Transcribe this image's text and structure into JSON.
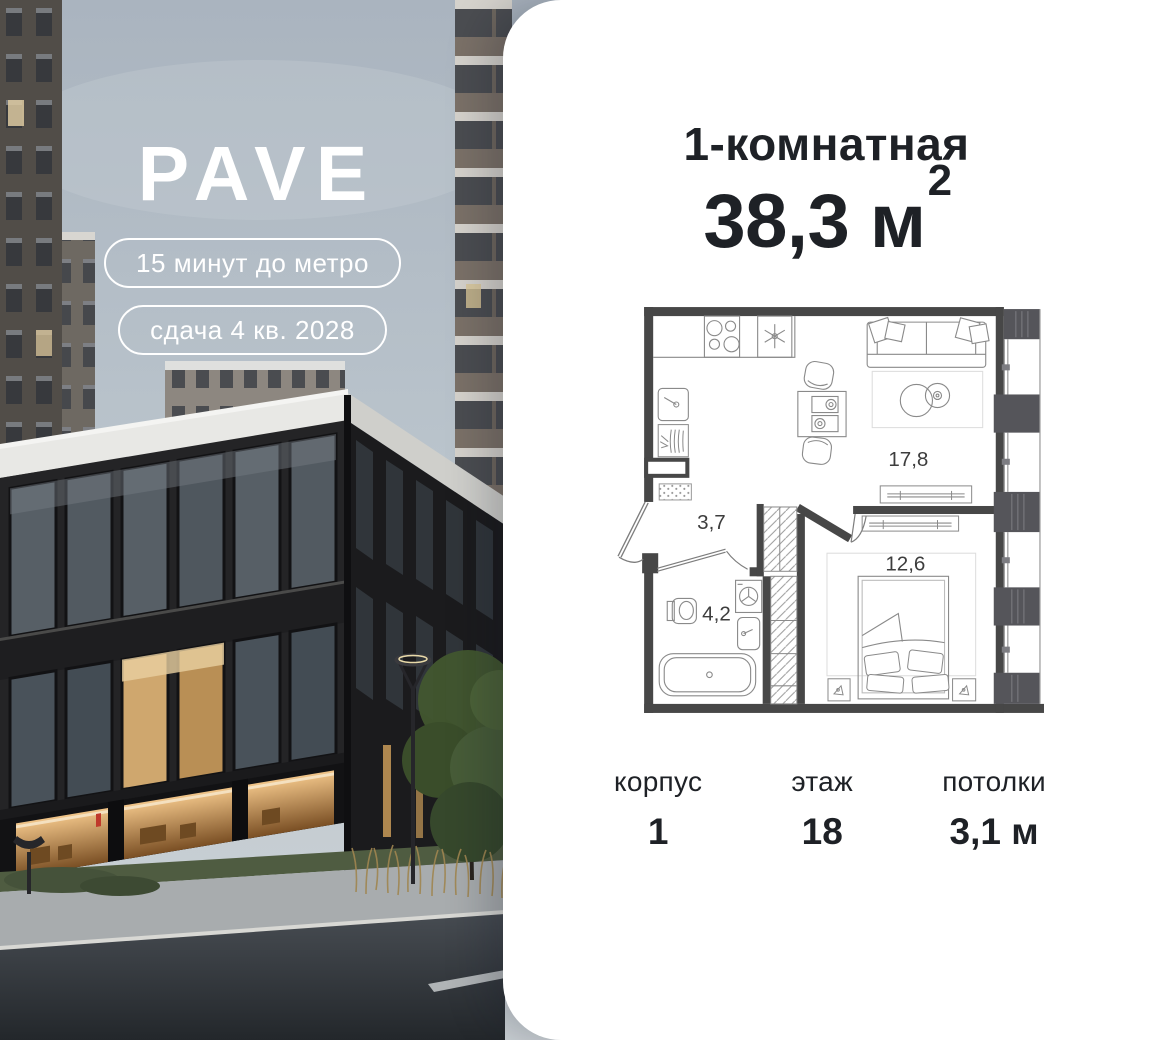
{
  "photo": {
    "logo": "PAVE",
    "badges": [
      "15 минут до метро",
      "сдача 4 кв. 2028"
    ]
  },
  "card": {
    "title": "1-комнатная",
    "area": {
      "value": "38,3 м",
      "sup": "2"
    },
    "specs": [
      {
        "label": "корпус",
        "value": "1"
      },
      {
        "label": "этаж",
        "value": "18"
      },
      {
        "label": "потолки",
        "value": "3,1 м"
      }
    ]
  },
  "plan": {
    "rooms": [
      {
        "name": "kitchen-living",
        "area": "17,8"
      },
      {
        "name": "hallway",
        "area": "3,7"
      },
      {
        "name": "bathroom",
        "area": "4,2"
      },
      {
        "name": "bedroom",
        "area": "12,6"
      }
    ]
  },
  "colors": {
    "card_bg": "#ffffff",
    "text": "#1e2126",
    "plan_wall": "#474747",
    "sky_top": "#aab4bf",
    "sky_bottom": "#ccd2d6",
    "accent_red": "#c0392b"
  }
}
